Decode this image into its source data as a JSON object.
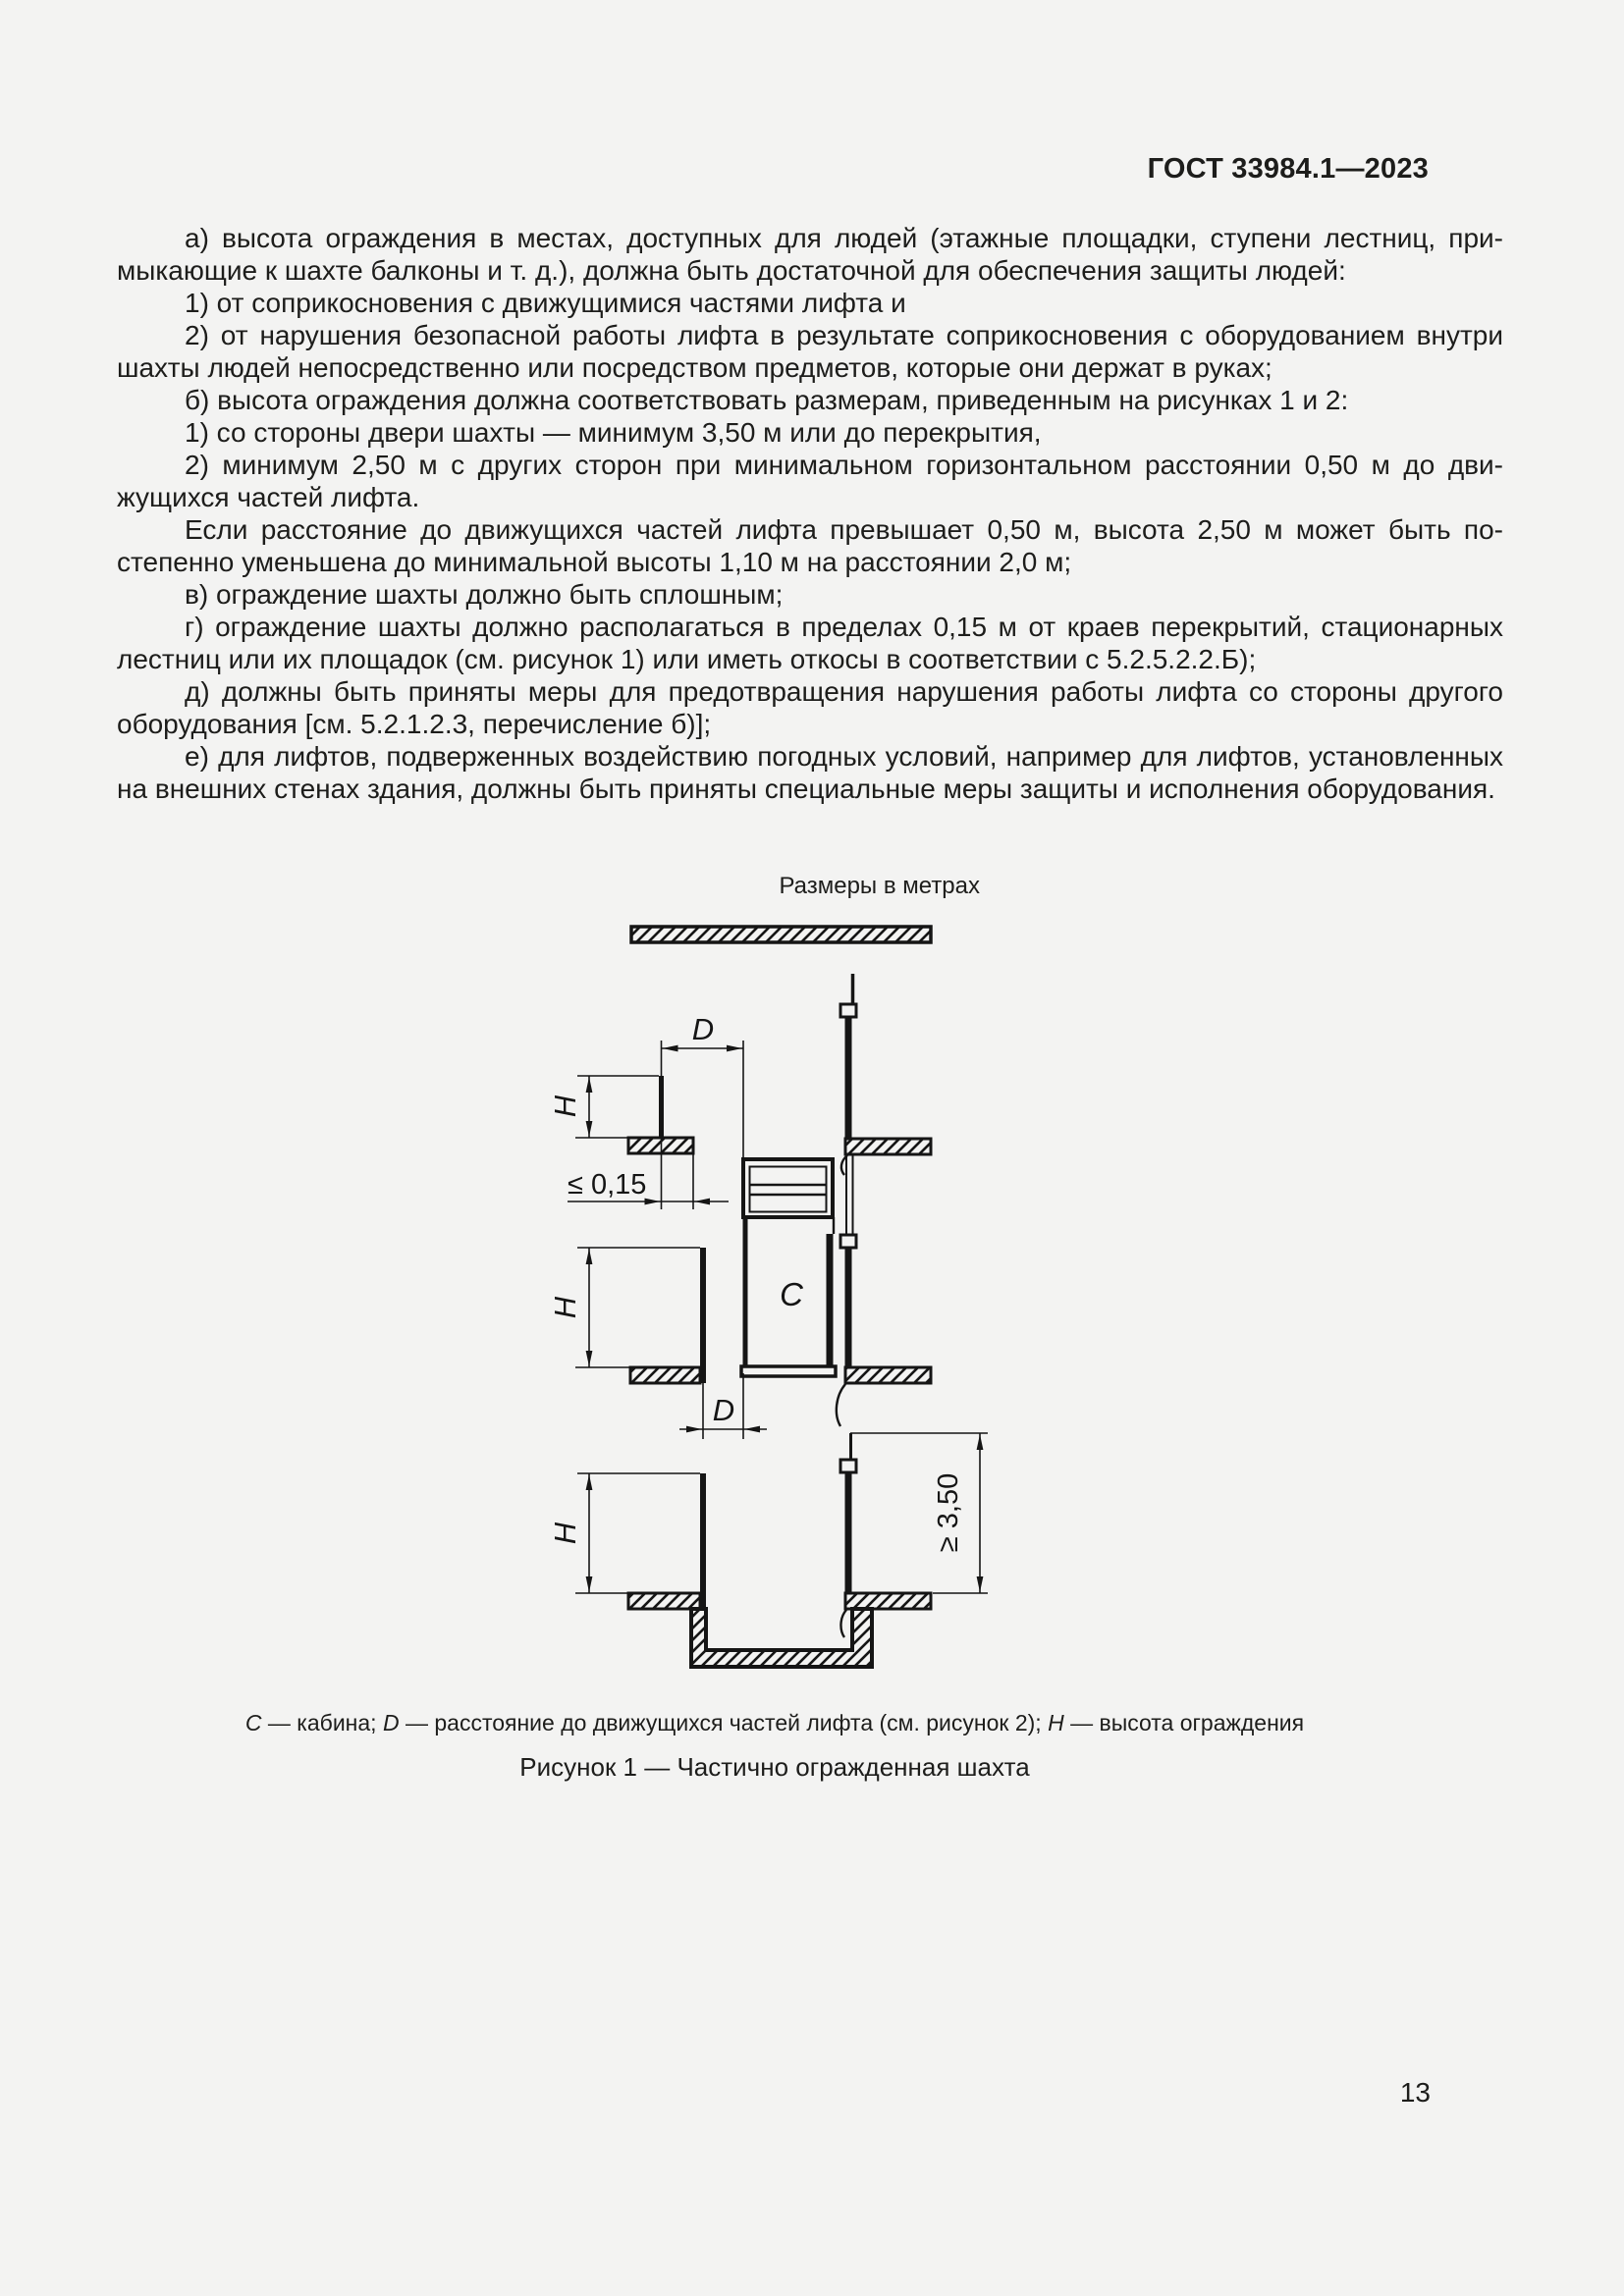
{
  "page": {
    "header": "ГОСТ 33984.1—2023",
    "page_number": "13",
    "units_note": "Размеры в метрах"
  },
  "body": {
    "paragraphs": [
      "а) высота ограждения в местах, доступных для людей (этажные площадки, ступени лестниц, при­мыкающие к шахте балконы и т. д.), должна быть достаточной для обеспечения защиты людей:",
      "1) от соприкосновения с движущимися частями лифта и",
      "2) от нарушения безопасной работы лифта в результате соприкосновения с оборудованием вну­три шахты людей непосредственно или посредством предметов, которые они держат в руках;",
      "б) высота ограждения должна соответствовать размерам, приведенным на рисунках 1 и 2:",
      "1) со стороны двери шахты — минимум 3,50 м или до перекрытия,",
      "2) минимум 2,50 м с других сторон при минимальном горизонтальном расстоянии 0,50 м до дви­жущихся частей лифта.",
      "Если расстояние до движущихся частей лифта превышает 0,50 м, высота 2,50 м может быть по­степенно уменьшена до минимальной высоты 1,10 м на расстоянии 2,0 м;",
      "в) ограждение шахты должно быть сплошным;",
      "г) ограждение шахты должно располагаться в пределах 0,15 м от краев перекрытий, стационар­ных лестниц или их площадок (см. рисунок 1) или иметь откосы в соответствии с 5.2.5.2.2.Б);",
      "д) должны быть приняты меры для предотвращения нарушения работы лифта со стороны другого оборудования [см. 5.2.1.2.3, перечисление б)];",
      "е) для лифтов, подверженных воздействию погодных условий, например для лифтов, установ­ленных на внешних стенах здания, должны быть приняты специальные меры защиты и исполнения оборудования."
    ]
  },
  "figure": {
    "labels": {
      "distance": "D",
      "height": "H",
      "cabin": "C",
      "fence_offset": "≤ 0,15",
      "door_side_height": "≥ 3,50"
    },
    "caption": {
      "c": "C",
      "c_text": " — кабина; ",
      "d": "D",
      "d_text": " — расстояние до движущихся частей лифта (см. рисунок 2); ",
      "h": "H",
      "h_text": " — высота ограждения"
    },
    "title": "Рисунок 1 — Частично огражденная шахта"
  },
  "colors": {
    "page_bg": "#f3f3f2",
    "ink": "#1d1d1b",
    "drawing": "#151515"
  }
}
